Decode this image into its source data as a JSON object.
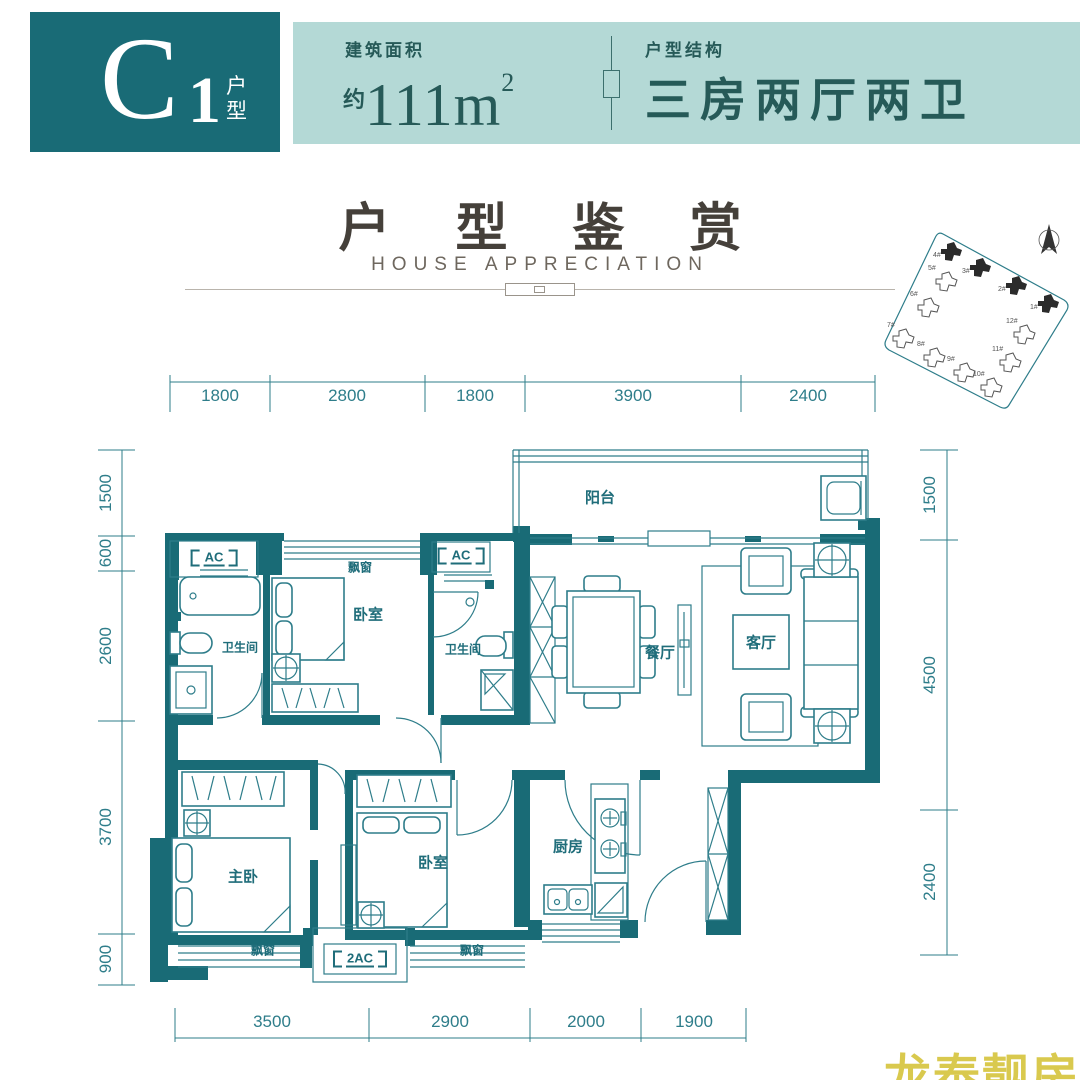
{
  "header": {
    "unit_code": "C",
    "unit_number": "1",
    "unit_char1": "户",
    "unit_char2": "型",
    "area_label": "建筑面积",
    "area_prefix": "约",
    "area_value": "111m",
    "area_sup": "2",
    "structure_label": "户型结构",
    "structure_value": "三房两厅两卫"
  },
  "title": {
    "zh": "户 型 鉴 赏",
    "en": "HOUSE APPRECIATION"
  },
  "site_plan": {
    "buildings": [
      {
        "label": "1#",
        "highlighted": true
      },
      {
        "label": "2#",
        "highlighted": true
      },
      {
        "label": "3#",
        "highlighted": true
      },
      {
        "label": "4#",
        "highlighted": true
      },
      {
        "label": "5#",
        "highlighted": false
      },
      {
        "label": "6#",
        "highlighted": false
      },
      {
        "label": "7#",
        "highlighted": false
      },
      {
        "label": "8#",
        "highlighted": false
      },
      {
        "label": "9#",
        "highlighted": false
      },
      {
        "label": "10#",
        "highlighted": false
      },
      {
        "label": "11#",
        "highlighted": false
      },
      {
        "label": "12#",
        "highlighted": false
      }
    ]
  },
  "plan": {
    "labels": {
      "balcony": "阳台",
      "bay_window": "飘窗",
      "bedroom": "卧室",
      "bathroom": "卫生间",
      "dining": "餐厅",
      "living": "客厅",
      "master": "主卧",
      "kitchen": "厨房",
      "ac": "AC",
      "ac2": "2AC"
    },
    "dims": {
      "top": [
        "1800",
        "2800",
        "1800",
        "3900",
        "2400"
      ],
      "left": [
        "1500",
        "600",
        "2600",
        "3700",
        "900"
      ],
      "right": [
        "1500",
        "4500",
        "2400"
      ],
      "bottom": [
        "3500",
        "2900",
        "2000",
        "1900"
      ]
    }
  },
  "watermark": "龙泰靓房",
  "colors": {
    "teal_dark": "#196b76",
    "band_bg": "#b4d9d6",
    "band_text": "#265a58",
    "plan_line": "#2e7d8a",
    "title_text": "#45403a",
    "watermark": "#d9c94e"
  }
}
